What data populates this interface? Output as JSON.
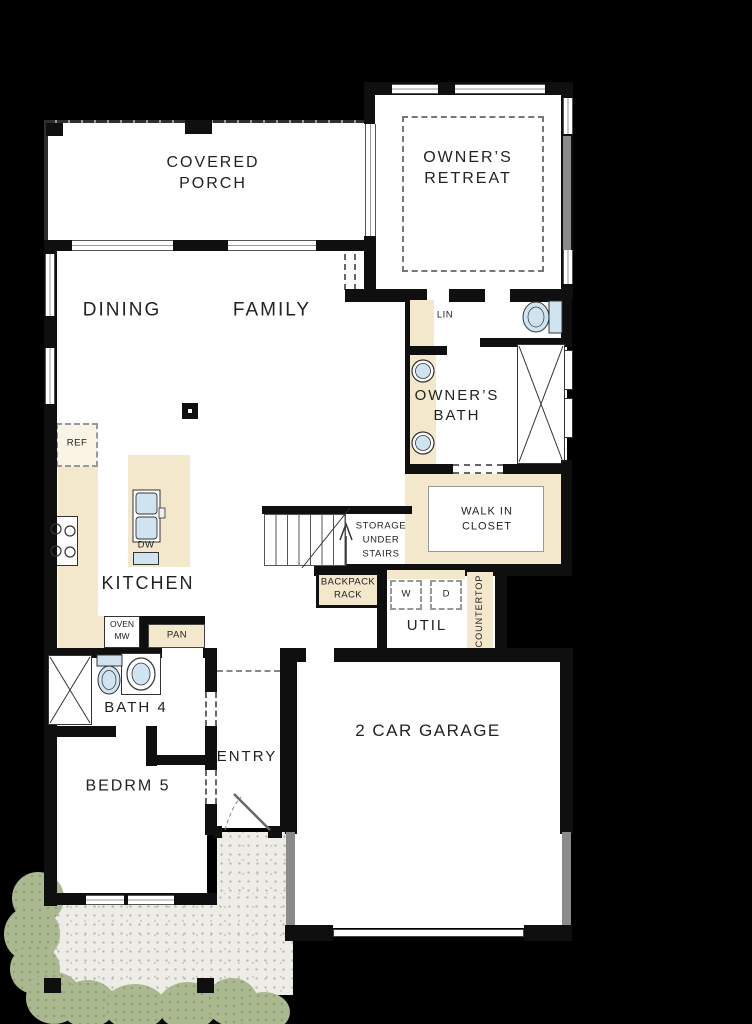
{
  "rooms": {
    "covered_porch": "COVERED PORCH",
    "owners_retreat": "OWNER’S RETREAT",
    "dining": "DINING",
    "family": "FAMILY",
    "owners_bath": "OWNER’S BATH",
    "kitchen": "KITCHEN",
    "walk_in_closet": "WALK IN CLOSET",
    "storage": "STORAGE UNDER STAIRS",
    "util": "UTIL",
    "entry": "ENTRY",
    "bath4": "BATH 4",
    "bedrm5": "BEDRM 5",
    "garage": "2 CAR GARAGE"
  },
  "fixtures": {
    "lin": "LIN",
    "ref": "REF",
    "dw": "DW",
    "oven_mw": "OVEN MW",
    "pan": "PAN",
    "washer": "W",
    "dryer": "D",
    "backpack_rack": "BACKPACK RACK",
    "countertop": "COUNTERTOP"
  },
  "colors": {
    "wall": "#0f0f0f",
    "floor": "#ffffff",
    "counter_tan": "#f3e7cc",
    "fixture_blue": "#cfe4f0",
    "bush_green": "#abb990",
    "patio_gray": "#edece7",
    "window_gray": "#8a8a8a",
    "text": "#222222"
  }
}
